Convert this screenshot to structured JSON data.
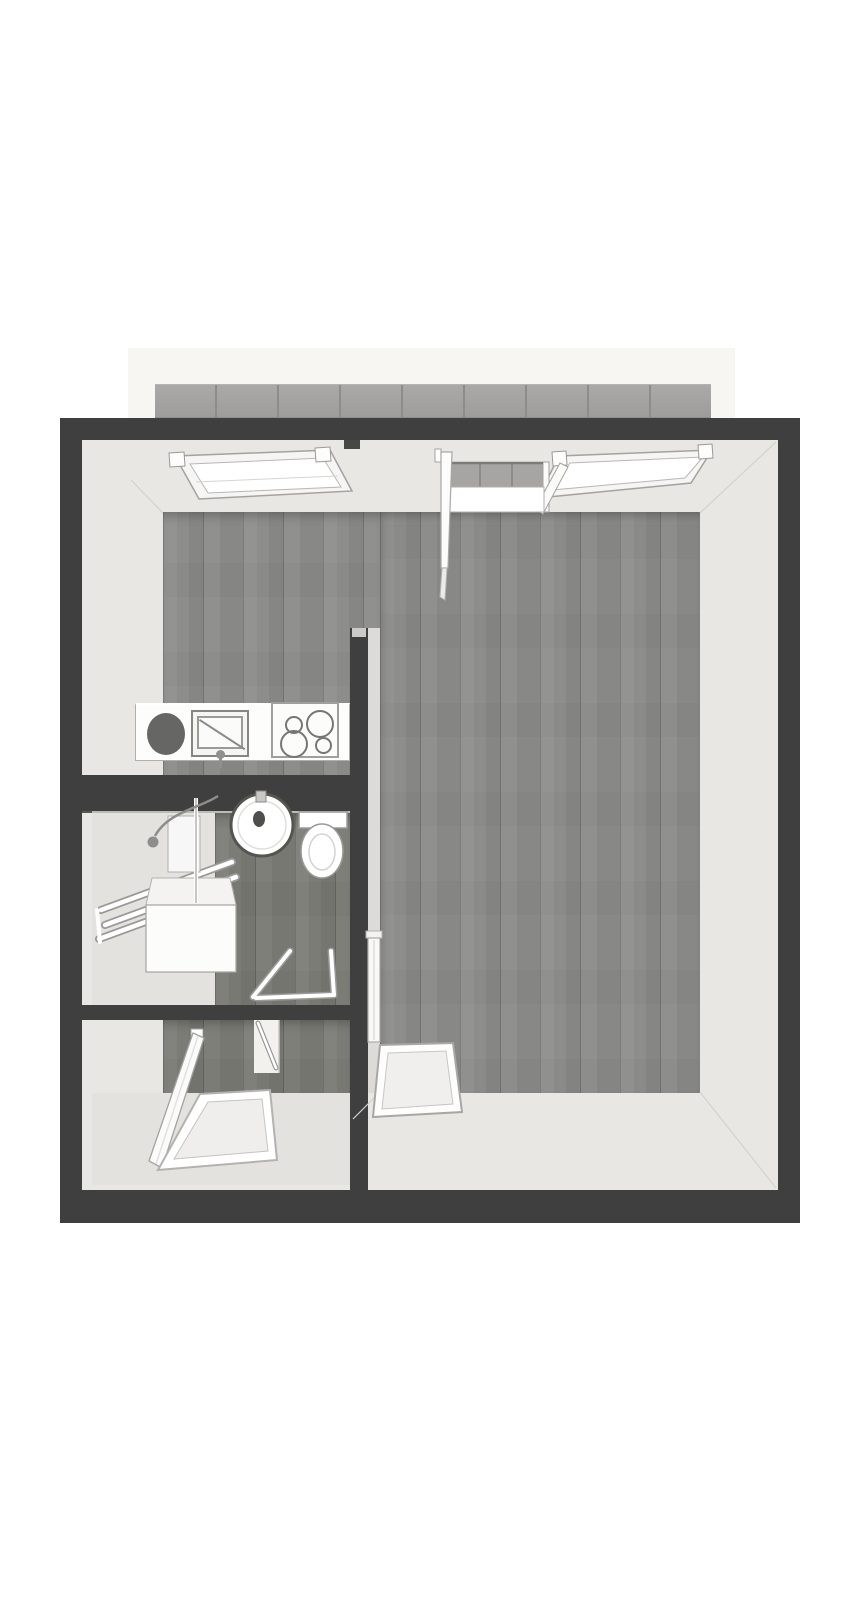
{
  "meta": {
    "title": "3D Floor Plan",
    "scene": "top-down-3d-apartment-render",
    "visible_text": []
  },
  "colors": {
    "page_bg": "#ffffff",
    "backdrop": "#f7f6f3",
    "balcony_tile": "#a6a5a3",
    "balcony_seam": "#8d8c8a",
    "wall_dark": "#3f3f3f",
    "wall_face_light": "#e8e7e3",
    "wall_face_shade": "#dcdbd7",
    "screed": "#e3e2de",
    "wood_main": "#8d8d8b",
    "wood_dark": "#7c7c77",
    "fixture_white": "#fdfdfc",
    "fixture_outline": "#a3a2a0",
    "fixture_outline_dark": "#7d7d7b",
    "sink_dark": "#666664"
  },
  "rooms": [
    "living-room",
    "kitchenette",
    "bathroom",
    "entrance-hall",
    "balcony"
  ],
  "fixtures": [
    "window-left",
    "window-right",
    "balcony-door-open",
    "kitchen-counter",
    "kitchen-sink",
    "cooktop-4-burners",
    "washbasin-round",
    "toilet",
    "bathtub-with-rails",
    "shower-head",
    "shower-screen",
    "bathroom-cabinet",
    "bathroom-door-open",
    "hall-door-open",
    "entry-door-open",
    "doormat-hall",
    "doormat-living-room"
  ]
}
